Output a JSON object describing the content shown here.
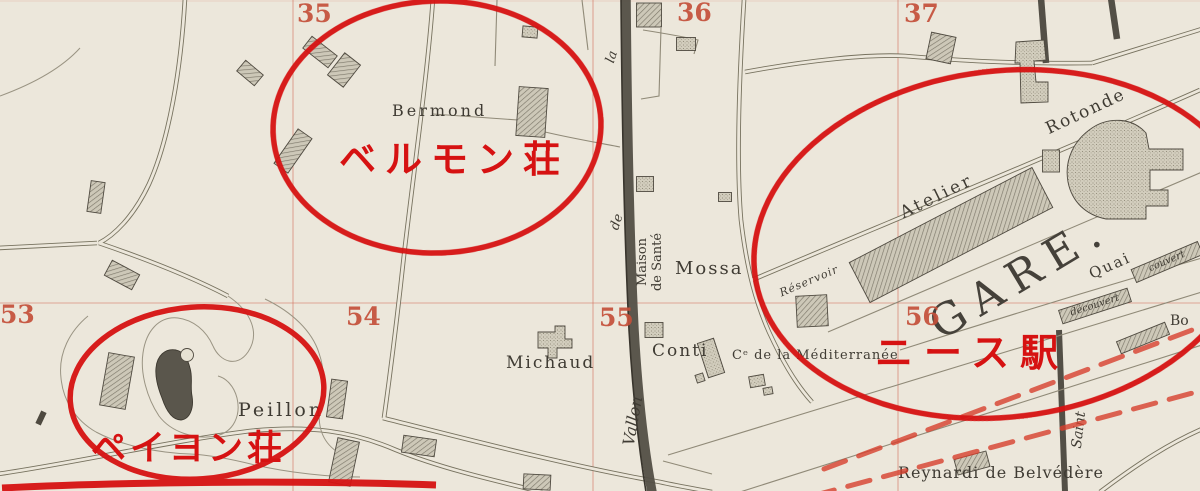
{
  "canvas": {
    "paper_color": "#ece7db",
    "ink_color": "#3f3b33",
    "grid_number_color": "#c4503a",
    "annotation_red": "#d61212",
    "railway_dash_red": "#d8402e"
  },
  "grid_numbers": [
    {
      "text": "35"
    },
    {
      "text": "36"
    },
    {
      "text": "37"
    },
    {
      "text": "53"
    },
    {
      "text": "54"
    },
    {
      "text": "55"
    },
    {
      "text": "56"
    }
  ],
  "map_labels": [
    {
      "text": "Bermond"
    },
    {
      "text": "Michaud"
    },
    {
      "text": "Conti"
    },
    {
      "text": "Cᵉ de la Méditerranée"
    },
    {
      "text": "Mossa"
    },
    {
      "text": "Maison de Santé"
    },
    {
      "text": "Peillon"
    },
    {
      "text": "Rotonde"
    },
    {
      "text": "Atelier"
    },
    {
      "text": "Réservoir"
    },
    {
      "text": "GARE."
    },
    {
      "text": "Quai"
    },
    {
      "text": "couvert"
    },
    {
      "text": "découvert"
    },
    {
      "text": "Bo"
    },
    {
      "text": "Reynardi de Belvédère"
    },
    {
      "text": "Saint"
    },
    {
      "text": "Vallon"
    },
    {
      "text": "de"
    },
    {
      "text": "la"
    }
  ],
  "annotations": {
    "color": "#d61212",
    "circled_areas": [
      {
        "name": "bermond-villa"
      },
      {
        "name": "peillon-villa"
      },
      {
        "name": "nice-station"
      }
    ],
    "texts": [
      {
        "text": "ベルモン荘"
      },
      {
        "text": "ペイヨン荘"
      },
      {
        "text": "ニース駅"
      }
    ]
  }
}
